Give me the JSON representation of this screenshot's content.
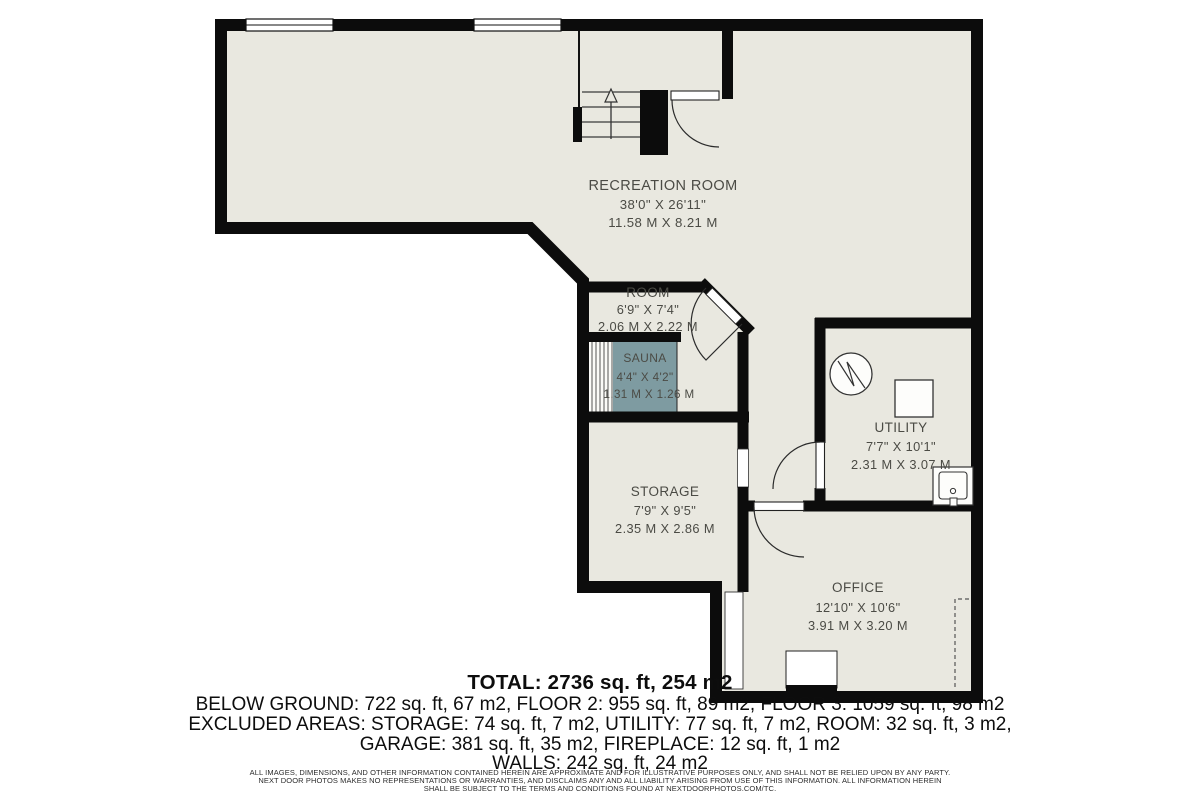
{
  "plan": {
    "colors": {
      "wall": "#0c0c0c",
      "floor": "#e9e8e0",
      "sauna_floor": "#7e9ba1",
      "label_text": "#4b4b45",
      "fixture_fill": "#fdfdfb"
    },
    "icons": {
      "stairs": "stairs-up-arrow-icon",
      "water_heater": "water-heater-circle-icon",
      "appliance": "appliance-square-icon",
      "sink": "utility-sink-icon",
      "doors": "door-swing-arc-icon",
      "windows": "window-icon",
      "low_ceiling": "dashed-boundary-icon"
    },
    "rooms": {
      "recreation": {
        "name": "RECREATION ROOM",
        "dim_ft": "38'0\" X 26'11\"",
        "dim_m": "11.58 M X 8.21 M"
      },
      "room": {
        "name": "ROOM",
        "dim_ft": "6'9\" X 7'4\"",
        "dim_m": "2.06 M X 2.22 M"
      },
      "sauna": {
        "name": "SAUNA",
        "dim_ft": "4'4\" X 4'2\"",
        "dim_m": "1.31 M X 1.26 M"
      },
      "storage": {
        "name": "STORAGE",
        "dim_ft": "7'9\" X 9'5\"",
        "dim_m": "2.35 M X 2.86 M"
      },
      "utility": {
        "name": "UTILITY",
        "dim_ft": "7'7\" X 10'1\"",
        "dim_m": "2.31 M X 3.07 M"
      },
      "office": {
        "name": "OFFICE",
        "dim_ft": "12'10\" X 10'6\"",
        "dim_m": "3.91 M X 3.20 M"
      }
    }
  },
  "summary": {
    "total": "TOTAL: 2736 sq. ft, 254 m2",
    "floors": "BELOW GROUND: 722 sq. ft, 67 m2, FLOOR 2: 955 sq. ft, 89 m2, FLOOR 3: 1059 sq. ft, 98 m2",
    "excluded1": "EXCLUDED AREAS: STORAGE: 74 sq. ft, 7 m2, UTILITY: 77 sq. ft, 7 m2, ROOM: 32 sq. ft, 3 m2,",
    "excluded2": "GARAGE: 381 sq. ft, 35 m2, FIREPLACE: 12 sq. ft, 1 m2",
    "walls": "WALLS: 242 sq. ft, 24 m2"
  },
  "disclaimer": {
    "line1": "ALL IMAGES, DIMENSIONS, AND OTHER INFORMATION CONTAINED HEREIN ARE APPROXIMATE AND FOR ILLUSTRATIVE PURPOSES ONLY, AND SHALL NOT BE RELIED UPON BY ANY PARTY.",
    "line2": "NEXT DOOR PHOTOS MAKES NO REPRESENTATIONS OR WARRANTIES, AND DISCLAIMS ANY AND ALL LIABILITY ARISING FROM USE OF THIS INFORMATION. ALL INFORMATION HEREIN",
    "line3": "SHALL BE SUBJECT TO THE TERMS AND CONDITIONS FOUND AT NEXTDOORPHOTOS.COM/TC."
  }
}
